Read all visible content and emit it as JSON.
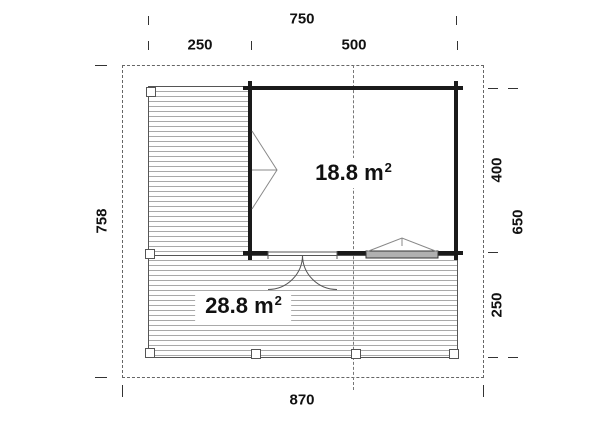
{
  "plan": {
    "areas": {
      "room": {
        "value": "18.8 m",
        "sup": "2"
      },
      "deck": {
        "value": "28.8 m",
        "sup": "2"
      }
    },
    "dimensions": {
      "top_total": "750",
      "top_left_segment": "250",
      "top_right_segment": "500",
      "left_height": "758",
      "right_building_depth": "400",
      "right_total": "650",
      "right_deck_depth": "250",
      "bottom_total": "870"
    },
    "colors": {
      "wall": "#1a1a1a",
      "deck_stripe": "#a9a9a9",
      "dashed_line": "#666666",
      "window_sill": "#b0b0b0"
    }
  }
}
